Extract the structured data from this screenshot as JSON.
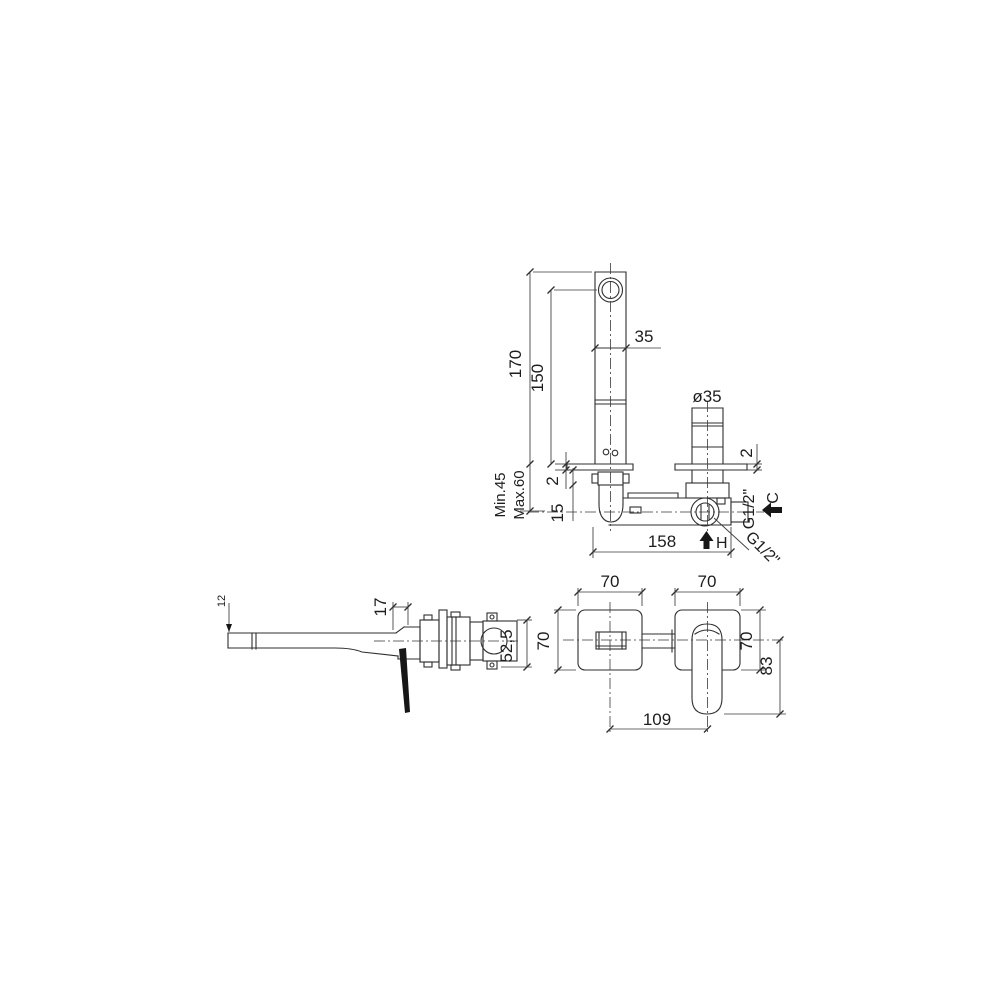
{
  "drawing": {
    "kind": "faucet installation technical drawing",
    "colors": {
      "background": "#ffffff",
      "line": "#2f2f2f",
      "text": "#1d1d1d",
      "arrow_fill": "#161616"
    },
    "labels": {
      "plan": {
        "dim_total_height": "170",
        "dim_outlet_height": "150",
        "dim_spout_width": "35",
        "dim_handle_diameter": "ø35",
        "dim_plate_thickness_left": "2",
        "dim_plate_thickness_right": "2",
        "dim_depth_min": "Min.45",
        "dim_depth_max": "Max.60",
        "dim_offset": "15",
        "dim_body_length": "158",
        "thread_inlet_side": "G1/2\"",
        "thread_inlet_bottom": "G1/2\"",
        "cold_marker": "C",
        "hot_marker": "H"
      },
      "side": {
        "dim_spout_tip": "12",
        "dim_trim_offset": "17",
        "dim_body_height": "52,5"
      },
      "front": {
        "dim_plate_width_left": "70",
        "dim_plate_width_right": "70",
        "dim_plate_height_left": "70",
        "dim_plate_height_right": "70",
        "dim_handle_drop": "83",
        "dim_center_distance": "109"
      }
    }
  }
}
